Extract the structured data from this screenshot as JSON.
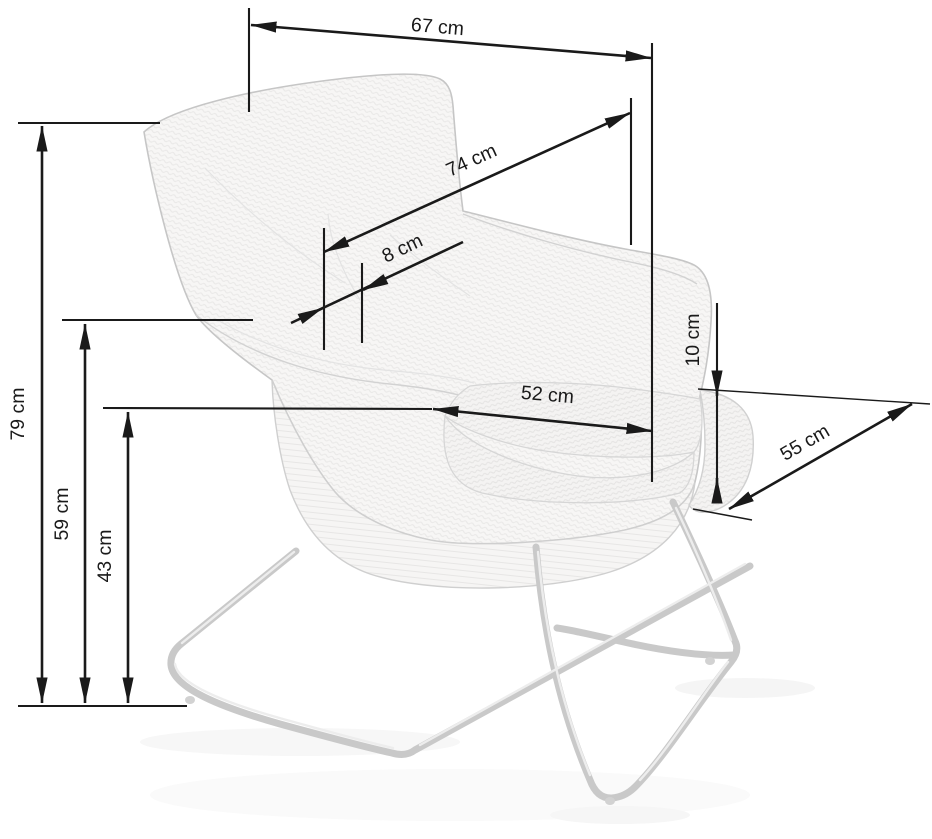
{
  "title": "Armchair dimensions diagram",
  "theme": {
    "line_color": "#1a1a1a",
    "chair_line": "#c9c9c9",
    "background": "#ffffff"
  },
  "unit": "cm",
  "dimensions": {
    "back_width": {
      "label": "67 cm",
      "value": 67,
      "unit": "cm",
      "description": "width across top of backrest"
    },
    "diagonal_depth": {
      "label": "74 cm",
      "value": 74,
      "unit": "cm",
      "description": "depth from backrest to arm front"
    },
    "shell_edge": {
      "label": "8 cm",
      "value": 8,
      "unit": "cm",
      "description": "shell edge thickness"
    },
    "cushion_thickness": {
      "label": "10 cm",
      "value": 10,
      "unit": "cm",
      "description": "seat cushion thickness"
    },
    "seat_width": {
      "label": "52 cm",
      "value": 52,
      "unit": "cm",
      "description": "seat width"
    },
    "base_depth": {
      "label": "55 cm",
      "value": 55,
      "unit": "cm",
      "description": "base / seat depth"
    },
    "total_height": {
      "label": "79 cm",
      "value": 79,
      "unit": "cm",
      "description": "total height"
    },
    "armrest_height": {
      "label": "59 cm",
      "value": 59,
      "unit": "cm",
      "description": "height to shell edge"
    },
    "seat_height": {
      "label": "43 cm",
      "value": 43,
      "unit": "cm",
      "description": "seat height"
    }
  }
}
